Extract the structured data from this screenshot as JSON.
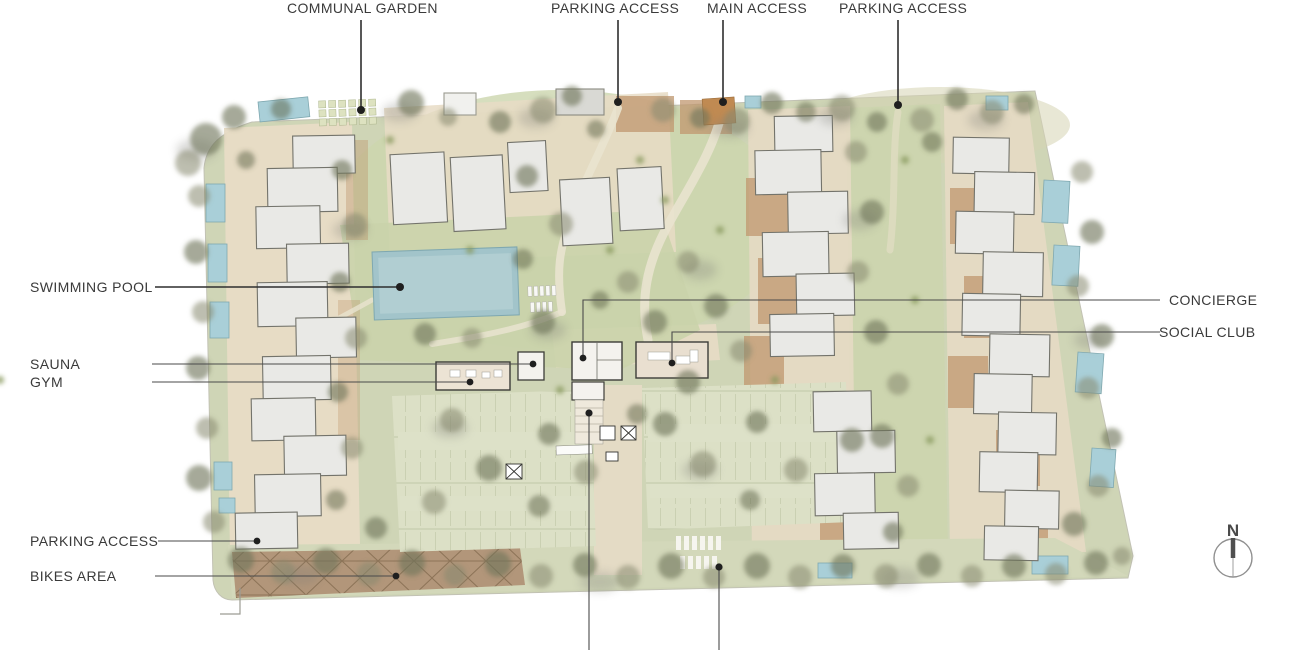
{
  "labels": {
    "communal_garden": "COMMUNAL GARDEN",
    "parking_access_top_west": "PARKING ACCESS",
    "main_access": "MAIN ACCESS",
    "parking_access_top_east": "PARKING ACCESS",
    "swimming_pool": "SWIMMING POOL",
    "sauna": "SAUNA",
    "gym": "GYM",
    "concierge": "CONCIERGE",
    "social_club": "SOCIAL CLUB",
    "parking_access_west": "PARKING ACCESS",
    "bikes_area": "BIKES AREA"
  },
  "compass": {
    "north_letter": "N"
  },
  "colors": {
    "background": "#ffffff",
    "site_green": "#cfd5b6",
    "lawn_green": "#c9d3a9",
    "parking_surface": "#dce0c6",
    "paving_beige": "#e8dcc6",
    "terracotta": "#c0976f",
    "pool_blue": "#a3c8d0",
    "building_fill": "#e9e9e6",
    "building_stroke": "#73736b",
    "tree_olive": "#6f7458",
    "label_text": "#3a3a3a",
    "leader_line": "#2e2e2e"
  }
}
